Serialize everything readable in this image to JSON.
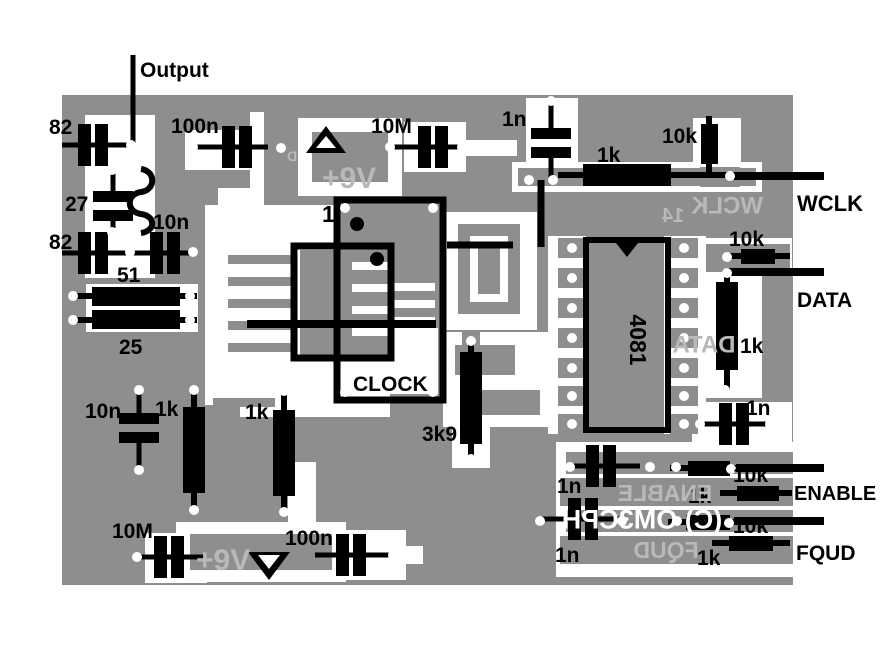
{
  "copyright": "(C) OM3CPH",
  "colors": {
    "background": "#ffffff",
    "board": "#8e8e8e",
    "trace": "#ffffff",
    "silkscreen": "#b9b9b9",
    "component": "#000000",
    "pad_hole": "#ffffff"
  },
  "canvas": {
    "w": 881,
    "h": 660
  },
  "board": [
    62,
    95,
    731,
    490
  ],
  "layers": {
    "white": [
      [
        85,
        115,
        70,
        163
      ],
      [
        86,
        284,
        112,
        48
      ],
      [
        185,
        130,
        78,
        40
      ],
      [
        250,
        112,
        14,
        83
      ],
      [
        218,
        188,
        46,
        48
      ],
      [
        298,
        118,
        104,
        78
      ],
      [
        404,
        122,
        62,
        50
      ],
      [
        462,
        140,
        55,
        16
      ],
      [
        526,
        98,
        52,
        72
      ],
      [
        512,
        162,
        250,
        30
      ],
      [
        693,
        118,
        48,
        52
      ],
      [
        700,
        238,
        92,
        38
      ],
      [
        704,
        262,
        58,
        136
      ],
      [
        692,
        402,
        100,
        46
      ],
      [
        556,
        442,
        237,
        135
      ],
      [
        176,
        522,
        170,
        60
      ],
      [
        288,
        462,
        28,
        62
      ],
      [
        318,
        530,
        88,
        50
      ],
      [
        395,
        546,
        28,
        18
      ],
      [
        145,
        533,
        62,
        50
      ],
      [
        205,
        205,
        133,
        200
      ],
      [
        240,
        355,
        150,
        62
      ],
      [
        344,
        328,
        94,
        66
      ],
      [
        445,
        212,
        92,
        118
      ],
      [
        443,
        332,
        120,
        95
      ],
      [
        548,
        236,
        38,
        198
      ],
      [
        664,
        236,
        42,
        198
      ],
      [
        452,
        335,
        38,
        133
      ]
    ],
    "gray": [
      [
        312,
        132,
        76,
        50
      ],
      [
        518,
        168,
        238,
        18
      ],
      [
        700,
        167,
        40,
        20
      ],
      [
        458,
        224,
        62,
        90
      ],
      [
        706,
        244,
        84,
        28
      ],
      [
        566,
        452,
        227,
        22
      ],
      [
        560,
        478,
        233,
        28
      ],
      [
        566,
        510,
        227,
        22
      ],
      [
        560,
        536,
        233,
        28
      ],
      [
        190,
        534,
        142,
        36
      ],
      [
        300,
        250,
        88,
        106
      ],
      [
        344,
        206,
        94,
        122
      ],
      [
        455,
        345,
        60,
        30
      ],
      [
        470,
        390,
        70,
        25
      ],
      [
        462,
        332,
        18,
        18
      ],
      [
        558,
        238,
        28,
        20
      ],
      [
        558,
        268,
        28,
        20
      ],
      [
        558,
        298,
        28,
        20
      ],
      [
        558,
        328,
        28,
        20
      ],
      [
        558,
        358,
        28,
        20
      ],
      [
        558,
        386,
        28,
        20
      ],
      [
        558,
        414,
        28,
        20
      ],
      [
        670,
        238,
        28,
        20
      ],
      [
        670,
        268,
        28,
        20
      ],
      [
        670,
        298,
        28,
        20
      ],
      [
        670,
        328,
        28,
        20
      ],
      [
        670,
        358,
        28,
        20
      ],
      [
        670,
        386,
        28,
        20
      ],
      [
        670,
        414,
        28,
        20
      ]
    ],
    "white2": [
      [
        470,
        236,
        38,
        66
      ]
    ],
    "gray2": [
      [
        478,
        244,
        22,
        50
      ]
    ]
  },
  "combs": [
    {
      "x": 228,
      "y": 255,
      "w": 65,
      "h": 9,
      "step": 22,
      "n": 5,
      "color": "board"
    },
    {
      "x": 352,
      "y": 262,
      "w": 36,
      "h": 8,
      "step": 22,
      "n": 4,
      "color": "trace"
    },
    {
      "x": 393,
      "y": 283,
      "w": 42,
      "h": 8,
      "step": 17,
      "n": 3,
      "color": "trace"
    },
    {
      "x": 213,
      "y": 398,
      "w": 62,
      "h": 9,
      "step": 21,
      "n": 3,
      "color": "board"
    }
  ],
  "lines": [
    [
      133,
      55,
      133,
      147,
      5
    ],
    [
      734,
      176,
      824,
      176,
      8
    ],
    [
      727,
      272,
      824,
      272,
      8
    ],
    [
      736,
      468,
      824,
      468,
      8
    ],
    [
      734,
      521,
      824,
      521,
      8
    ],
    [
      247,
      324,
      436,
      324,
      8
    ],
    [
      447,
      245,
      513,
      245,
      7
    ],
    [
      541,
      180,
      541,
      247,
      7
    ]
  ],
  "caps_v": [
    [
      93,
      145,
      62,
      131
    ],
    [
      237,
      147,
      195,
      268
    ],
    [
      433,
      147,
      390,
      462
    ],
    [
      93,
      253,
      62,
      130
    ],
    [
      165,
      253,
      133,
      193
    ],
    [
      169,
      557,
      135,
      205
    ],
    [
      351,
      555,
      315,
      393
    ],
    [
      601,
      466,
      567,
      640
    ],
    [
      583,
      519,
      542,
      620
    ],
    [
      734,
      424,
      699,
      770
    ]
  ],
  "caps_h": [
    [
      113,
      206,
      170,
      191,
      221,
      234
    ],
    [
      551,
      143,
      101,
      128,
      158,
      180
    ],
    [
      139,
      428,
      390,
      413,
      443,
      470
    ]
  ],
  "res_h": [
    [
      583,
      164,
      88,
      22,
      175,
      558,
      583,
      671,
      736
    ],
    [
      741,
      249,
      34,
      15,
      256,
      727,
      741,
      775,
      790
    ],
    [
      688,
      461,
      42,
      15,
      468,
      670,
      688,
      730,
      737
    ],
    [
      737,
      486,
      42,
      15,
      493,
      720,
      737,
      779,
      792
    ],
    [
      686,
      515,
      44,
      15,
      522,
      668,
      686,
      730,
      735
    ],
    [
      729,
      536,
      44,
      15,
      543,
      712,
      729,
      773,
      790
    ],
    [
      92,
      287,
      88,
      19,
      296,
      70,
      92,
      180,
      197
    ],
    [
      92,
      310,
      88,
      19,
      320,
      70,
      92,
      180,
      197
    ]
  ],
  "res_v": [
    [
      183,
      407,
      22,
      86,
      194,
      391,
      407,
      493,
      509
    ],
    [
      273,
      410,
      22,
      86,
      284,
      393,
      410,
      496,
      511
    ],
    [
      460,
      352,
      22,
      92,
      471,
      340,
      352,
      444,
      459
    ],
    [
      716,
      282,
      22,
      88,
      727,
      270,
      282,
      370,
      391
    ],
    [
      701,
      124,
      17,
      40,
      709,
      116,
      124,
      164,
      178
    ]
  ],
  "coil": {
    "path": "M141,169 C156,171 156,190 141,192 C126,194 126,212 141,214 C156,216 156,231 141,233",
    "width": 6
  },
  "triangles": [
    {
      "outer": "326,126 306,153 346,153",
      "inner": "326,136 316,148 336,148"
    },
    {
      "outer": "248,552 290,552 269,580",
      "inner": "258,555 280,555 269,569"
    }
  ],
  "notch": "616,243 638,243 627,257",
  "dots": [
    [
      357,
      224,
      7
    ],
    [
      377,
      259,
      7
    ]
  ],
  "pads": [
    [
      131,
      145
    ],
    [
      193,
      147
    ],
    [
      390,
      147
    ],
    [
      462,
      147
    ],
    [
      551,
      101
    ],
    [
      529,
      180
    ],
    [
      553,
      180
    ],
    [
      730,
      176
    ],
    [
      112,
      170
    ],
    [
      133,
      170
    ],
    [
      112,
      232
    ],
    [
      130,
      252
    ],
    [
      193,
      252
    ],
    [
      73,
      296
    ],
    [
      73,
      320
    ],
    [
      190,
      296
    ],
    [
      190,
      320
    ],
    [
      139,
      390
    ],
    [
      139,
      470
    ],
    [
      194,
      390
    ],
    [
      194,
      510
    ],
    [
      284,
      391
    ],
    [
      284,
      512
    ],
    [
      345,
      208
    ],
    [
      433,
      208
    ],
    [
      345,
      392
    ],
    [
      433,
      392
    ],
    [
      471,
      341
    ],
    [
      471,
      459
    ],
    [
      572,
      248
    ],
    [
      572,
      278
    ],
    [
      572,
      308
    ],
    [
      572,
      338
    ],
    [
      572,
      368
    ],
    [
      572,
      396
    ],
    [
      572,
      424
    ],
    [
      684,
      248
    ],
    [
      684,
      278
    ],
    [
      684,
      308
    ],
    [
      684,
      338
    ],
    [
      684,
      368
    ],
    [
      684,
      396
    ],
    [
      684,
      424
    ],
    [
      727,
      257
    ],
    [
      727,
      273
    ],
    [
      725,
      390
    ],
    [
      700,
      424
    ],
    [
      770,
      424
    ],
    [
      570,
      467
    ],
    [
      650,
      467
    ],
    [
      676,
      467
    ],
    [
      731,
      469
    ],
    [
      540,
      521
    ],
    [
      622,
      521
    ],
    [
      677,
      521
    ],
    [
      729,
      523
    ],
    [
      137,
      557
    ],
    [
      393,
      555
    ],
    [
      281,
      148
    ]
  ],
  "ics": [
    [
      337,
      200,
      106,
      200,
      7
    ],
    [
      294,
      246,
      97,
      112,
      7
    ],
    [
      586,
      240,
      82,
      190,
      6
    ]
  ],
  "labels": [
    {
      "text": "Output",
      "x": 140,
      "y": 77,
      "s": 21,
      "c": "black"
    },
    {
      "text": "82",
      "x": 49,
      "y": 134,
      "s": 21,
      "c": "black"
    },
    {
      "text": "100n",
      "x": 171,
      "y": 133,
      "s": 21,
      "c": "black"
    },
    {
      "text": "10M",
      "x": 371,
      "y": 133,
      "s": 21,
      "c": "black"
    },
    {
      "text": "1n",
      "x": 502,
      "y": 126,
      "s": 21,
      "c": "black"
    },
    {
      "text": "1k",
      "x": 597,
      "y": 162,
      "s": 21,
      "c": "black"
    },
    {
      "text": "10k",
      "x": 662,
      "y": 143,
      "s": 21,
      "c": "black"
    },
    {
      "text": "WCLK",
      "x": 797,
      "y": 211,
      "s": 22,
      "c": "black"
    },
    {
      "text": "27",
      "x": 65,
      "y": 211,
      "s": 21,
      "c": "black"
    },
    {
      "text": "10n",
      "x": 153,
      "y": 229,
      "s": 21,
      "c": "black"
    },
    {
      "text": "82",
      "x": 49,
      "y": 249,
      "s": 21,
      "c": "black"
    },
    {
      "text": "51",
      "x": 117,
      "y": 282,
      "s": 21,
      "c": "black"
    },
    {
      "text": "25",
      "x": 119,
      "y": 354,
      "s": 21,
      "c": "black"
    },
    {
      "text": "10k",
      "x": 729,
      "y": 246,
      "s": 21,
      "c": "black"
    },
    {
      "text": "DATA",
      "x": 797,
      "y": 307,
      "s": 21,
      "c": "black"
    },
    {
      "text": "1",
      "x": 322,
      "y": 222,
      "s": 23,
      "c": "black"
    },
    {
      "text": "CLOCK",
      "x": 353,
      "y": 391,
      "s": 21,
      "c": "black"
    },
    {
      "text": "4081",
      "cx": 630,
      "cy": 340,
      "s": 23,
      "c": "black",
      "rot": 90
    },
    {
      "text": "1k",
      "x": 740,
      "y": 353,
      "s": 21,
      "c": "black"
    },
    {
      "text": "3k9",
      "x": 422,
      "y": 441,
      "s": 21,
      "c": "black"
    },
    {
      "text": "1n",
      "x": 746,
      "y": 415,
      "s": 21,
      "c": "black"
    },
    {
      "text": "10n",
      "x": 85,
      "y": 418,
      "s": 21,
      "c": "black"
    },
    {
      "text": "1k",
      "x": 155,
      "y": 416,
      "s": 21,
      "c": "black"
    },
    {
      "text": "1k",
      "x": 245,
      "y": 419,
      "s": 21,
      "c": "black"
    },
    {
      "text": "10k",
      "x": 733,
      "y": 482,
      "s": 21,
      "c": "black"
    },
    {
      "text": "ENABLE",
      "x": 794,
      "y": 500,
      "s": 20,
      "c": "black"
    },
    {
      "text": "1k",
      "x": 688,
      "y": 503,
      "s": 21,
      "c": "black"
    },
    {
      "text": "1n",
      "x": 557,
      "y": 493,
      "s": 21,
      "c": "black"
    },
    {
      "text": "10k",
      "x": 733,
      "y": 533,
      "s": 21,
      "c": "black"
    },
    {
      "text": "FQUD",
      "x": 796,
      "y": 560,
      "s": 21,
      "c": "black"
    },
    {
      "text": "1k",
      "x": 697,
      "y": 565,
      "s": 21,
      "c": "black"
    },
    {
      "text": "1n",
      "x": 555,
      "y": 562,
      "s": 21,
      "c": "black"
    },
    {
      "text": "10M",
      "x": 112,
      "y": 538,
      "s": 21,
      "c": "black"
    },
    {
      "text": "100n",
      "x": 285,
      "y": 545,
      "s": 21,
      "c": "black"
    },
    {
      "text": "+9V",
      "x": 322,
      "y": 188,
      "s": 30,
      "c": "silk"
    },
    {
      "text": "+9V",
      "x": 196,
      "y": 570,
      "s": 30,
      "c": "silk"
    },
    {
      "text": "WCLK",
      "cx": 727,
      "cy": 205,
      "s": 24,
      "c": "silk",
      "mir": 1
    },
    {
      "text": "14",
      "cx": 673,
      "cy": 215,
      "s": 20,
      "c": "silk",
      "mir": 1
    },
    {
      "text": "DATA",
      "cx": 704,
      "cy": 344,
      "s": 24,
      "c": "silk",
      "mir": 1
    },
    {
      "text": "ENABLE",
      "cx": 665,
      "cy": 493,
      "s": 23,
      "c": "silk",
      "mir": 1
    },
    {
      "text": "FQUD",
      "cx": 666,
      "cy": 550,
      "s": 23,
      "c": "silk",
      "mir": 1
    },
    {
      "text": "(C) OM3CPH",
      "cx": 642,
      "cy": 519,
      "s": 27,
      "c": "white",
      "mir": 1
    },
    {
      "text": "D",
      "cx": 292,
      "cy": 156,
      "s": 14,
      "c": "silk",
      "mir": 1
    }
  ]
}
